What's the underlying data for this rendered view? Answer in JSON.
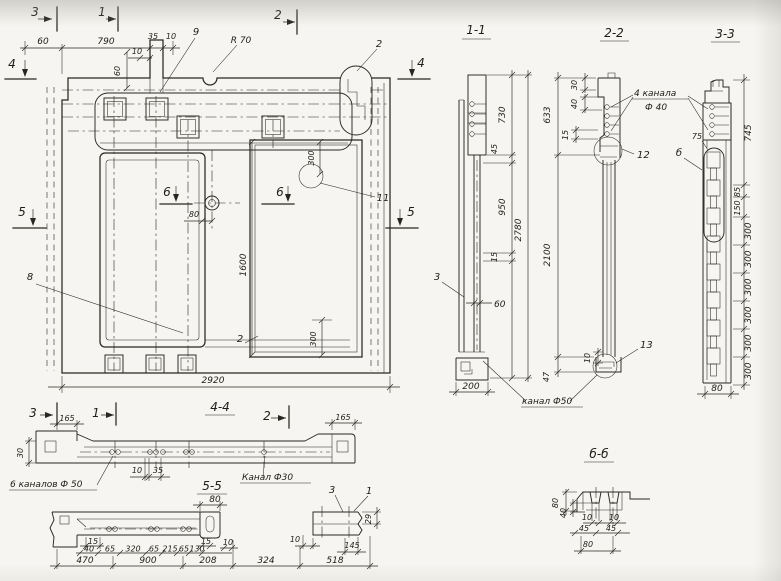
{
  "colors": {
    "ink": "#2a2722",
    "paper": "#f6f5f1"
  },
  "main": {
    "marks": {
      "m3": "3",
      "m1": "1",
      "m2": "2",
      "m4l": "4",
      "m4r": "4",
      "m5l": "5",
      "m5r": "5",
      "m6l": "6",
      "m6r": "6"
    },
    "dims": {
      "d60": "60",
      "d790": "790",
      "d35": "35",
      "d10a": "10",
      "d10b": "10",
      "d60v": "60",
      "d80": "80",
      "d300t": "300",
      "d1600": "1600",
      "d300b": "300",
      "d2920": "2920"
    },
    "labels": {
      "l9": "9",
      "l2": "2",
      "r70": "R 70",
      "l11": "11",
      "l8": "8",
      "l2b": "2"
    }
  },
  "s11": {
    "title": "1-1",
    "d730": "730",
    "d45": "45",
    "d950": "950",
    "d15": "15",
    "d2780": "2780",
    "d60": "60",
    "d200": "200",
    "l3": "3",
    "note": "канал Ф50"
  },
  "s22": {
    "title": "2-2",
    "d30": "30",
    "d40": "40",
    "d15": "15",
    "d633": "633",
    "d2100": "2100",
    "d10": "10",
    "d47": "47",
    "l12": "12",
    "l13": "13",
    "note1": "4 канала",
    "note2": "Ф 40"
  },
  "s33": {
    "title": "3-3",
    "d745": "745",
    "d85": "85",
    "d150": "150",
    "d300": [
      "300",
      "300",
      "300",
      "300",
      "300",
      "300"
    ],
    "d80": "80",
    "d75": "75",
    "lb": "б"
  },
  "s44": {
    "title": "4-4",
    "m3": "3",
    "m1": "1",
    "m2": "2",
    "d165l": "165",
    "d165r": "165",
    "d30": "30",
    "d10": "10",
    "d35": "35",
    "note6": "6 каналов Ф 50",
    "note3": "Канал Ф30"
  },
  "s55": {
    "title": "5-5",
    "d80": "80",
    "row1": [
      "15",
      "40",
      "65",
      "320",
      "65",
      "215",
      "65",
      "130",
      "15",
      "10"
    ],
    "row2": [
      "470",
      "900",
      "208",
      "324",
      "518"
    ],
    "l3": "3",
    "l1": "1",
    "d29": "29",
    "d10": "10",
    "d145": "145"
  },
  "s66": {
    "title": "б-б",
    "d80a": "80",
    "d40": "40",
    "d10a": "10",
    "d10b": "10",
    "d45a": "45",
    "d45b": "45",
    "d80b": "80"
  }
}
